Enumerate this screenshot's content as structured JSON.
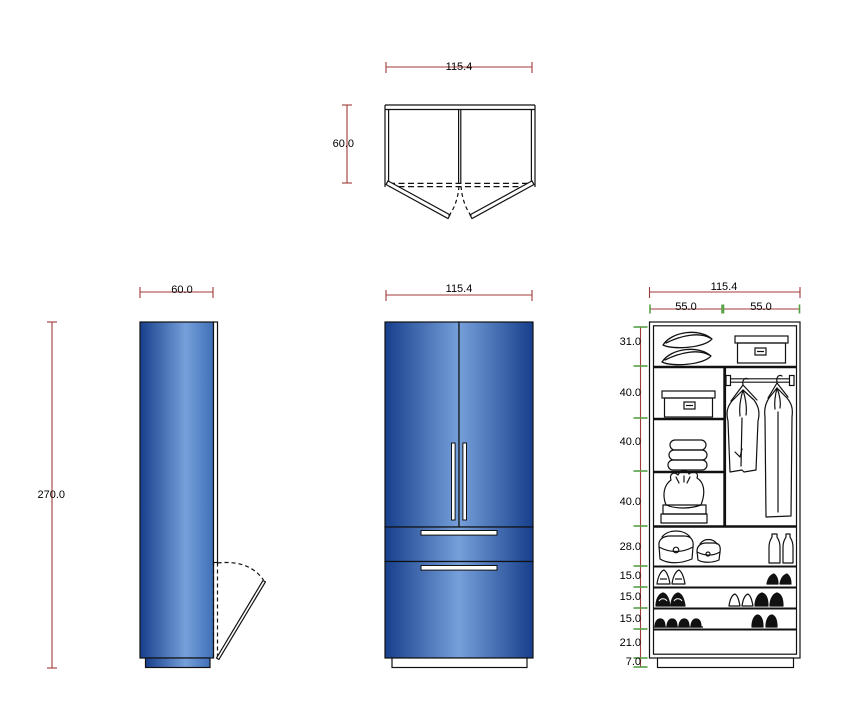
{
  "drawing": {
    "type": "furniture-technical-drawing",
    "colors": {
      "background": "#ffffff",
      "dimension_line": "#a03a3a",
      "dimension_tick": "#55a044",
      "outline": "#111111",
      "cabinet_dark_blue": "#173f8c",
      "cabinet_light_blue": "#76a0da"
    },
    "views": {
      "plan": {
        "width": "115.4",
        "depth": "60.0"
      },
      "side": {
        "width": "60.0",
        "height": "270.0"
      },
      "front": {
        "width": "115.4"
      },
      "interior": {
        "width": "115.4",
        "bays": [
          "55.0",
          "55.0"
        ],
        "sections": [
          "31.0",
          "40.0",
          "40.0",
          "40.0",
          "28.0",
          "15.0",
          "15.0",
          "15.0",
          "21.0",
          "7.0"
        ],
        "contents": [
          "pillows",
          "storage-box",
          "storage-box",
          "hanging-rod",
          "jacket",
          "long-coat",
          "folded-clothes",
          "laundry-bag",
          "handbags",
          "bottles",
          "high-heels",
          "shoes",
          "slippers"
        ]
      }
    }
  }
}
